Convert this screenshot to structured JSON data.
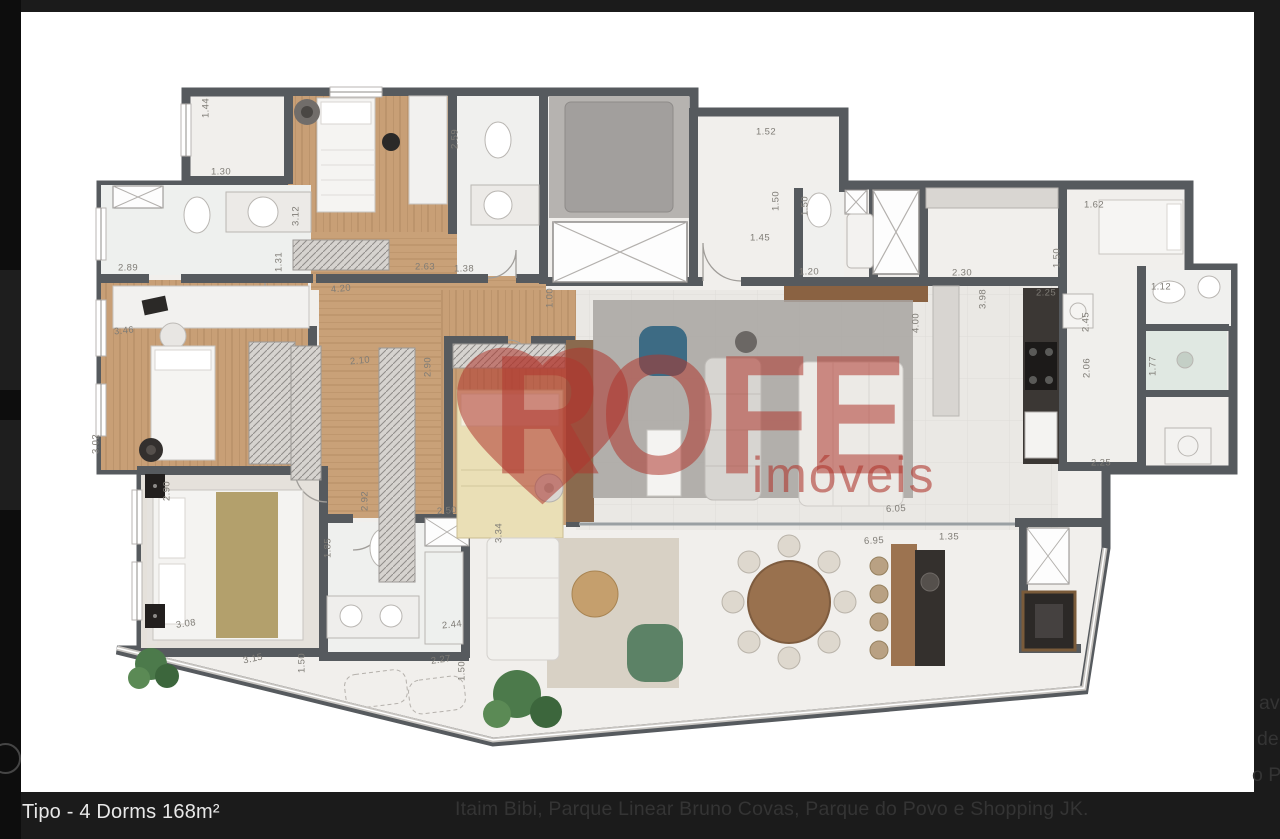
{
  "colors": {
    "page_bg": "#191919",
    "wall": "#565a5e",
    "wood": "#c79e74",
    "accent_red": "#b1382e",
    "caption_text": "#e8e8e8",
    "muted_text": "#343434"
  },
  "carousel": {
    "caption": "Tipo - 4 Dorms 168m²"
  },
  "background_text": {
    "line": "Itaim Bibi, Parque Linear Bruno Covas, Parque do Povo e Shopping JK.",
    "fragments": [
      "av",
      "de",
      "o P"
    ]
  },
  "watermark": {
    "brand": "ROFE",
    "subtitle": "imóveis"
  },
  "plan": {
    "type": "apartment-floor-plan",
    "labels": [
      {
        "t": "1.44",
        "x": 206,
        "y": 108,
        "r": -90
      },
      {
        "t": "1.30",
        "x": 221,
        "y": 172,
        "r": 0
      },
      {
        "t": "2.89",
        "x": 128,
        "y": 268,
        "r": 0
      },
      {
        "t": "3.46",
        "x": 124,
        "y": 331,
        "r": -6
      },
      {
        "t": "3.02",
        "x": 96,
        "y": 444,
        "r": -90
      },
      {
        "t": "2.90",
        "x": 167,
        "y": 491,
        "r": -90
      },
      {
        "t": "3.08",
        "x": 186,
        "y": 624,
        "r": -8
      },
      {
        "t": "3.15",
        "x": 253,
        "y": 659,
        "r": -12
      },
      {
        "t": "1.50",
        "x": 302,
        "y": 663,
        "r": -90
      },
      {
        "t": "3.12",
        "x": 296,
        "y": 216,
        "r": -90
      },
      {
        "t": "1.31",
        "x": 279,
        "y": 262,
        "r": -90
      },
      {
        "t": "2.63",
        "x": 425,
        "y": 267,
        "r": 0
      },
      {
        "t": "1.38",
        "x": 464,
        "y": 269,
        "r": 0
      },
      {
        "t": "4.20",
        "x": 341,
        "y": 289,
        "r": -6
      },
      {
        "t": "2.10",
        "x": 360,
        "y": 361,
        "r": -6
      },
      {
        "t": "2.90",
        "x": 428,
        "y": 367,
        "r": -90
      },
      {
        "t": "1.00",
        "x": 550,
        "y": 298,
        "r": -90
      },
      {
        "t": "2.92",
        "x": 365,
        "y": 501,
        "r": -90
      },
      {
        "t": "2.50",
        "x": 447,
        "y": 511,
        "r": -4
      },
      {
        "t": "1.85",
        "x": 328,
        "y": 548,
        "r": -90
      },
      {
        "t": "2.44",
        "x": 452,
        "y": 625,
        "r": -6
      },
      {
        "t": "2.27",
        "x": 441,
        "y": 660,
        "r": -8
      },
      {
        "t": "1.50",
        "x": 462,
        "y": 671,
        "r": -90
      },
      {
        "t": "3.34",
        "x": 499,
        "y": 533,
        "r": -90
      },
      {
        "t": "2.59",
        "x": 455,
        "y": 139,
        "r": -90
      },
      {
        "t": "1.52",
        "x": 766,
        "y": 132,
        "r": 0
      },
      {
        "t": "1.50",
        "x": 776,
        "y": 201,
        "r": -90
      },
      {
        "t": "1.45",
        "x": 760,
        "y": 238,
        "r": 0
      },
      {
        "t": "1.50",
        "x": 805,
        "y": 206,
        "r": -90
      },
      {
        "t": "1.20",
        "x": 809,
        "y": 272,
        "r": 0
      },
      {
        "t": "2.30",
        "x": 962,
        "y": 273,
        "r": 0
      },
      {
        "t": "1.50",
        "x": 1057,
        "y": 258,
        "r": -90
      },
      {
        "t": "3.98",
        "x": 983,
        "y": 299,
        "r": -90
      },
      {
        "t": "2.25",
        "x": 1046,
        "y": 293,
        "r": 0
      },
      {
        "t": "4.00",
        "x": 916,
        "y": 323,
        "r": -90
      },
      {
        "t": "1.62",
        "x": 1094,
        "y": 205,
        "r": 0
      },
      {
        "t": "2.45",
        "x": 1086,
        "y": 322,
        "r": -90
      },
      {
        "t": "2.06",
        "x": 1087,
        "y": 368,
        "r": -90
      },
      {
        "t": "1.12",
        "x": 1161,
        "y": 287,
        "r": 0
      },
      {
        "t": "1.77",
        "x": 1153,
        "y": 366,
        "r": -90
      },
      {
        "t": "2.25",
        "x": 1101,
        "y": 463,
        "r": 0
      },
      {
        "t": "6.05",
        "x": 896,
        "y": 509,
        "r": -3
      },
      {
        "t": "6.95",
        "x": 874,
        "y": 541,
        "r": -3
      },
      {
        "t": "1.35",
        "x": 949,
        "y": 537,
        "r": 0
      }
    ]
  }
}
